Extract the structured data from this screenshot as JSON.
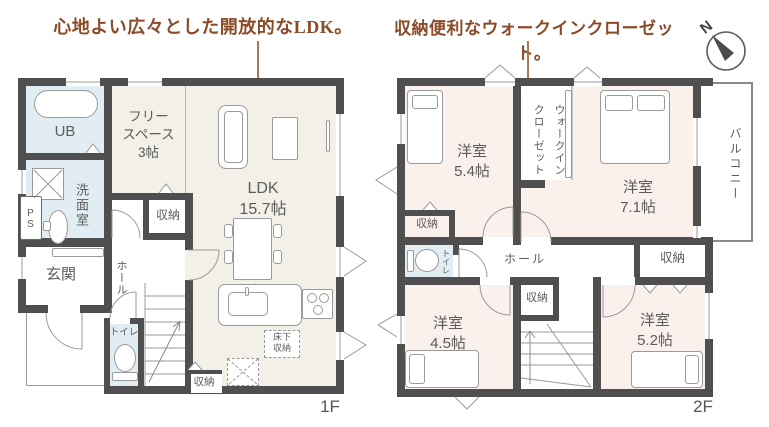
{
  "annotations": {
    "ldk_headline": "心地よい広々とした開放的なLDK。",
    "wic_headline": "収納便利なウォークインクローゼット。"
  },
  "compass": {
    "north": "N"
  },
  "shared": {
    "storage": "収納",
    "toilet": "トイレ",
    "hall": "ホール",
    "western_room": "洋室"
  },
  "floor1": {
    "floor_label": "1F",
    "ub": "UB",
    "washroom": "洗面室",
    "pipe_space": "PS",
    "free_space": {
      "name_line1": "フリー",
      "name_line2": "スペース",
      "size": "3帖"
    },
    "ldk": {
      "name": "LDK",
      "size": "15.7帖"
    },
    "entrance": "玄関",
    "underfloor_storage": {
      "line1": "床下",
      "line2": "収納"
    }
  },
  "floor2": {
    "floor_label": "2F",
    "walk_in_closet": {
      "line1": "ウォークイン",
      "line2": "クローゼット"
    },
    "balcony": "バルコニー",
    "room_5_4": {
      "size": "5.4帖"
    },
    "room_7_1": {
      "size": "7.1帖"
    },
    "room_4_5": {
      "size": "4.5帖"
    },
    "room_5_2": {
      "size": "5.2帖"
    }
  },
  "colors": {
    "accent_brown": "#8a4c28",
    "wall_gray": "#4f4f4f",
    "room_cream": "#f2f0e7",
    "room_pink": "#faf0ec",
    "wet_area_blue": "#e2edf3"
  }
}
